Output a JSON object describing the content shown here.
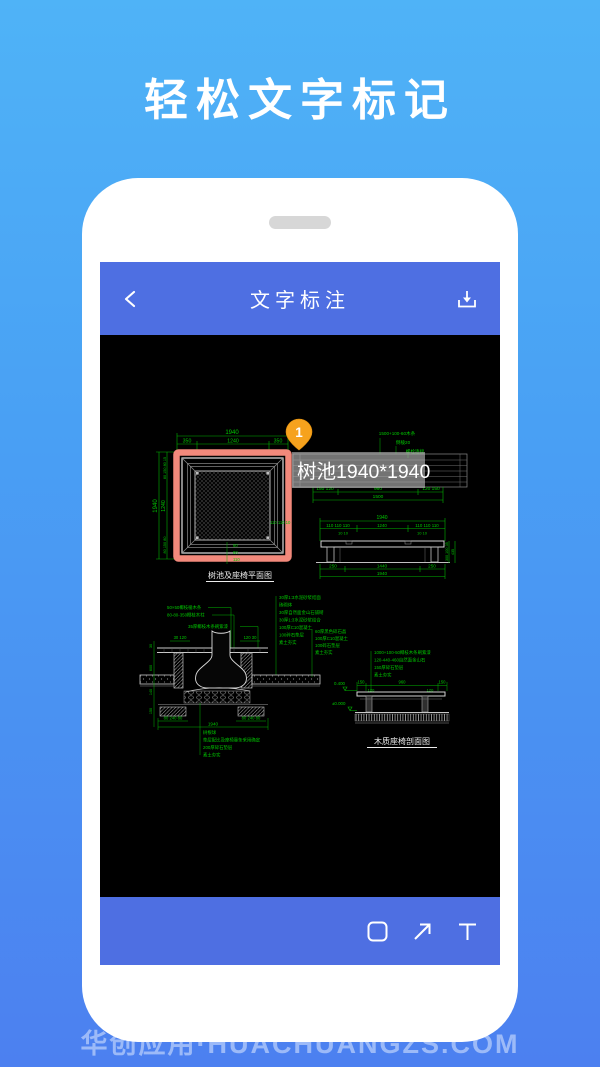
{
  "hero": {
    "title": "轻松文字标记"
  },
  "footer": {
    "brand": "华创应用·HUACHUANGZS.COM"
  },
  "app": {
    "header": {
      "title": "文字标注"
    },
    "toolbar": {
      "icons": [
        "rectangle",
        "arrow",
        "text"
      ]
    }
  },
  "annotation": {
    "marker_number": "1",
    "label_text": "树池1940*1940"
  },
  "cad": {
    "plan": {
      "caption": "树池及座椅平面图",
      "dim_total_top": "1940",
      "dims_top": [
        "350",
        "1240",
        "350"
      ],
      "dim_total_left": "1940",
      "dim_left_inner": "1240",
      "dims_left_top": "80 150 80 15",
      "dims_left_bottom": "80 150 80",
      "dims_inner_right": "110 110 10",
      "dims_inner_bottom": [
        "60",
        "60",
        "110"
      ]
    },
    "bench_plan": {
      "notes": [
        "1500+100-60木条",
        "倒棱20",
        "螺栓连接"
      ],
      "dims_bottom": [
        "150 120",
        "960",
        "120 150"
      ],
      "dim_total": "1500"
    },
    "bench_elevation": {
      "dim_total_top": "1940",
      "dims_row": [
        "110 110 110",
        "1240",
        "110 110 110"
      ],
      "dims_small_left": "10 10",
      "dims_small_right": "10 10",
      "dims_bottom": [
        "250",
        "1440",
        "250"
      ],
      "dim_total_bottom": "1940",
      "dims_right": [
        "100 35",
        "300",
        "435"
      ]
    },
    "pit_section": {
      "notes_left": [
        "50×50椰枝棱木条",
        "80-80-350椰枝木柱",
        "35厚椰枝木条刷紫漆"
      ],
      "dims_upper": [
        "30 120",
        "120 30"
      ],
      "notes_right": [
        "30厚1:3水泥砂浆结面",
        "砖砌体",
        "30厚自然面金山石铺砌",
        "30厚1:3水泥砂浆结合",
        "100厚C10混凝土",
        "100碎石垫层",
        "素土夯实"
      ],
      "notes_right2": [
        "60厚黑色碎石晶",
        "100厚C10混凝土",
        "100碎石垫层",
        "素土夯实"
      ],
      "dims_left_side": [
        "30",
        "600",
        "140",
        "150"
      ],
      "dims_footing": [
        "80 240 80",
        "80 240 80"
      ],
      "dim_total": "1940",
      "notes_bottom": [
        "树根球",
        "垫层配比及座椅靠条采用确定",
        "200厚碎石垫层",
        "素土夯实"
      ]
    },
    "bench_section": {
      "caption": "木质座椅剖面图",
      "notes": [
        "1000+100-50椰枝木条刷紫漆",
        "120-440-460自然面金山石",
        "150厚碎石垫层",
        "素土夯实"
      ],
      "dims_top": [
        "150",
        "960",
        "150"
      ],
      "dims_sub": [
        "120",
        "120"
      ],
      "elev_upper": "0.400",
      "elev_lower": "±0.000"
    }
  },
  "colors": {
    "bg_top": "#4FB3F7",
    "bg_bottom": "#4C80F0",
    "app_blue": "#4E6FE2",
    "cad_green": "#00B400",
    "highlight_red": "#F2897B",
    "marker_orange": "#F6A21D"
  }
}
